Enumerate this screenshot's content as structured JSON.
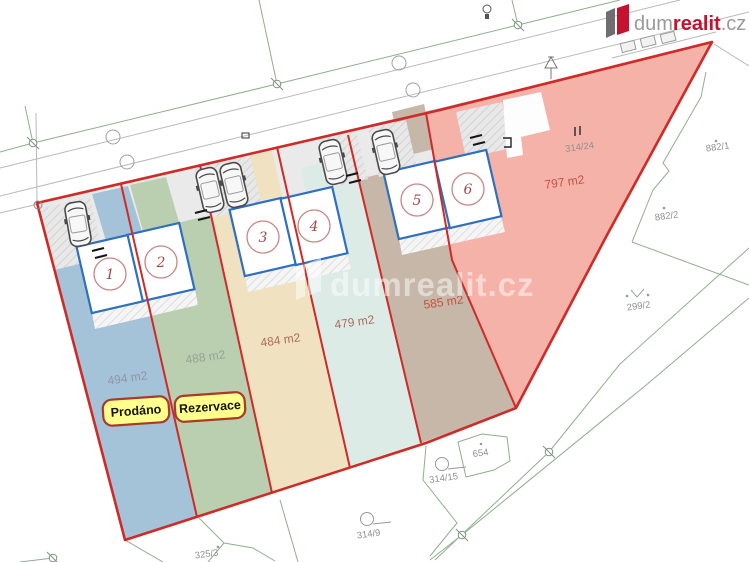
{
  "brand": {
    "name_gray": "dum",
    "name_red": "realit",
    "name_suffix": ".cz"
  },
  "watermark": {
    "text": "dumrealit.cz"
  },
  "badges": {
    "sold": "Prodáno",
    "reserved": "Rezervace"
  },
  "lots": [
    {
      "number": "1",
      "area": "494 m2",
      "color": "#a5c3d8",
      "status": "Prodáno"
    },
    {
      "number": "2",
      "area": "488 m2",
      "color": "#b9cfb0",
      "status": "Rezervace"
    },
    {
      "number": "3",
      "area": "484 m2",
      "color": "#f0e2c0"
    },
    {
      "number": "4",
      "area": "479 m2",
      "color": "#dcebe5"
    },
    {
      "number": "5",
      "area": "585 m2",
      "color": "#c6b7a8"
    },
    {
      "number": "6",
      "area": "797 m2",
      "color": "#f5b2a8"
    }
  ],
  "parcels": {
    "p314_24": "314/24",
    "p882_1": "882/1",
    "p882_2": "882/2",
    "p299_2": "299/2",
    "p654": "654",
    "p314_15": "314/15",
    "p314_9": "314/9",
    "p325_3": "325/3"
  },
  "colors": {
    "boundary_red": "#cf2a27",
    "house_blue": "#2f6fc0",
    "badge_yellow": "#ffff8e",
    "brand_red": "#c41230"
  }
}
